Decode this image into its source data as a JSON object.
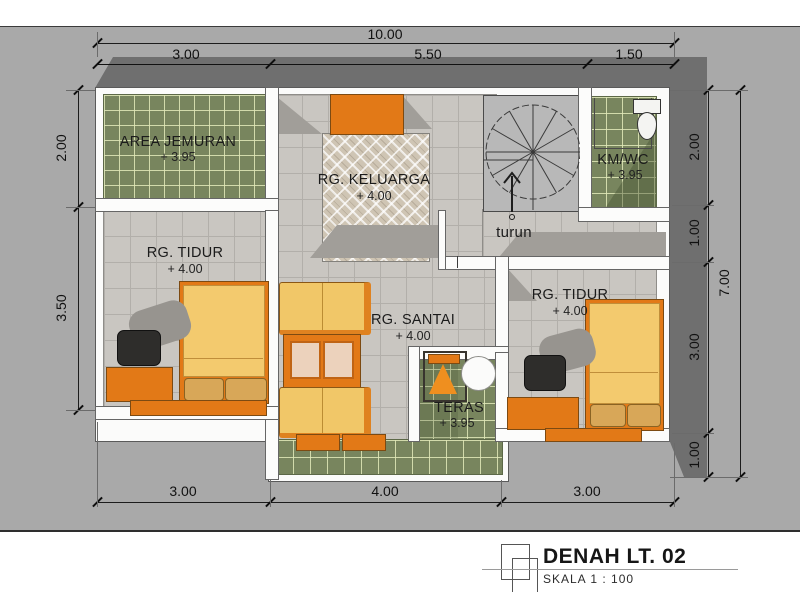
{
  "drawing": {
    "title": "DENAH LT. 02",
    "scale": "SKALA  1 : 100"
  },
  "rooms": {
    "area_jemuran": {
      "name": "AREA JEMURAN",
      "elev": "+ 3.95"
    },
    "rg_keluarga": {
      "name": "RG. KELUARGA",
      "elev": "+ 4.00"
    },
    "km_wc": {
      "name": "KM/WC",
      "elev": "+ 3.95"
    },
    "rg_tidur_kiri": {
      "name": "RG. TIDUR",
      "elev": "+ 4.00"
    },
    "rg_santai": {
      "name": "RG. SANTAI",
      "elev": "+ 4.00"
    },
    "rg_tidur_kanan": {
      "name": "RG. TIDUR",
      "elev": "+ 4.00"
    },
    "teras": {
      "name": "TERAS",
      "elev": "+ 3.95"
    },
    "stair": {
      "label": "turun"
    }
  },
  "dimensions": {
    "top_total": "10.00",
    "top": [
      "3.00",
      "5.50",
      "1.50"
    ],
    "left": [
      "2.00",
      "3.50"
    ],
    "right": [
      "2.00",
      "1.00",
      "3.00",
      "1.00"
    ],
    "right_total": "7.00",
    "bottom": [
      "3.00",
      "4.00",
      "3.00"
    ]
  },
  "icons": {
    "stair": "spiral-stair-icon",
    "toilet": "toilet-icon",
    "logo": "overlapping-squares-icon"
  },
  "colors": {
    "accent_orange": "#e27917",
    "tile_green": "#78855e",
    "floor_gray": "#c9c6c1",
    "roof_gray": "#6f6f6f",
    "bed_yellow": "#f3ca6e",
    "background_gray": "#a9a9a9"
  }
}
